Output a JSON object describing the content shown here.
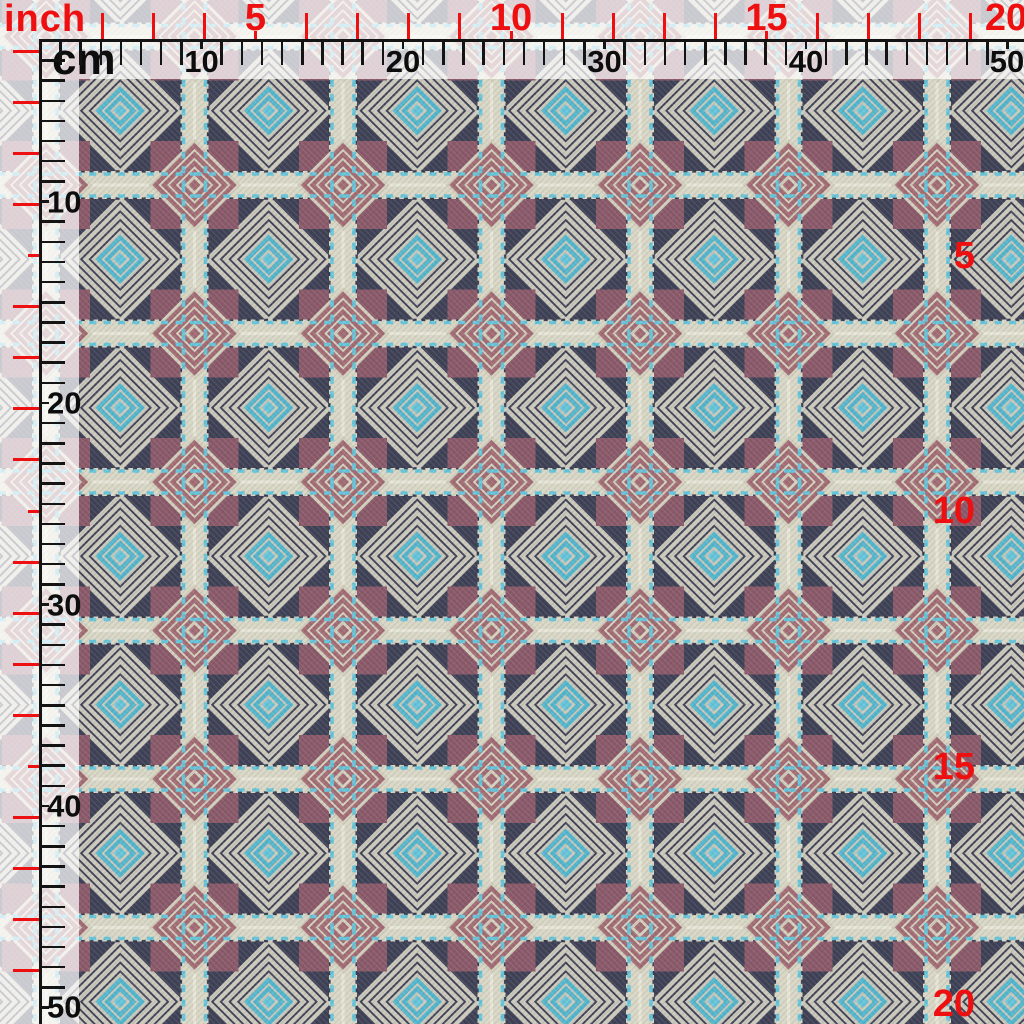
{
  "page": {
    "type": "fabric-swatch-measurement-preview"
  },
  "units": {
    "inch_label": "inch",
    "cm_label": "cm"
  },
  "rulers": {
    "inch": {
      "px_per_unit": 51.1,
      "max_units": 20,
      "labeled_units": [
        5,
        10,
        15,
        20
      ]
    },
    "cm": {
      "px_per_unit": 20.15,
      "max_units": 50,
      "labeled_units": [
        10,
        20,
        30,
        40,
        50
      ]
    }
  },
  "colors": {
    "red": "#ee1010",
    "overlay": "rgba(255,255,255,0.72)",
    "navy": "#3f4156",
    "ringlight": "#cbc9bc",
    "band": "#d9d7c6",
    "bandhi": "#e7e6d7",
    "teeth": "#383a4e",
    "plum": "#8b5a6a",
    "cream": "#d5d1bf",
    "rose": "#a36d75",
    "blue": "#67c5da",
    "blue2": "#55b7cd"
  }
}
